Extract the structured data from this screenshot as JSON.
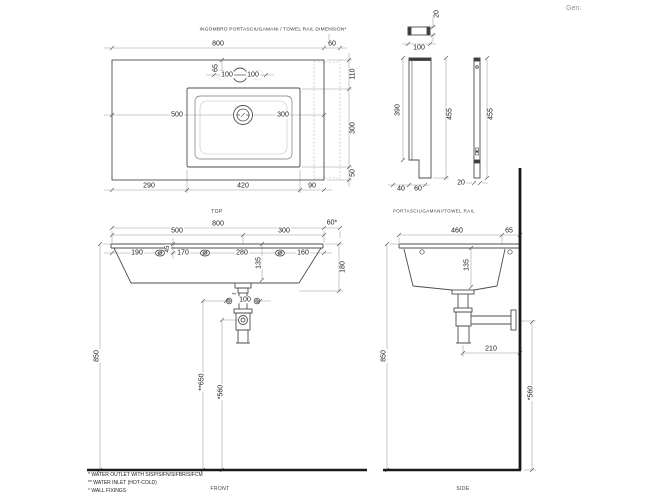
{
  "header": {
    "gen": "Gen:"
  },
  "top_view": {
    "note": "INGOMBRO PORTASCIUGAMANI / TOWEL RAIL DIMENSION*",
    "label": "TOP",
    "d800": "800",
    "d60": "60",
    "d110": "110",
    "d300_right": "300",
    "d50": "50",
    "d65": "65",
    "d100_left": "100",
    "d100_right": "100",
    "d500": "500",
    "d300_center": "300",
    "d290": "290",
    "d420": "420",
    "d90": "90"
  },
  "rail_view": {
    "label": "PORTASCIUGAMANI/TOWEL RAIL",
    "d20_top": "20",
    "d100": "100",
    "d390": "390",
    "d455_front": "455",
    "d455_side": "455",
    "d40": "40",
    "d60": "60",
    "d20_side": "20"
  },
  "front_view": {
    "label": "FRONT",
    "d800": "800",
    "d60": "60*",
    "d500": "500",
    "d300": "300",
    "d190": "190",
    "d170": "170",
    "d280": "280",
    "d160": "160",
    "d45": "45",
    "d135": "135",
    "d180": "180",
    "inlet_marks": "**",
    "d100": "100",
    "d850": "850",
    "d650": "**650",
    "d560": "*560"
  },
  "side_view": {
    "label": "SIDE",
    "d460": "460",
    "d65": "65",
    "d135": "135",
    "d210": "210",
    "d850": "850",
    "d560": "*560"
  },
  "footnotes": {
    "line1": "* WATER OUTLET WITH SISP/SIFN/SIFBR/SIFCM",
    "line2": "** WATER INLET  (HOT-COLD)",
    "line3": "° WALL FIXINGS"
  }
}
